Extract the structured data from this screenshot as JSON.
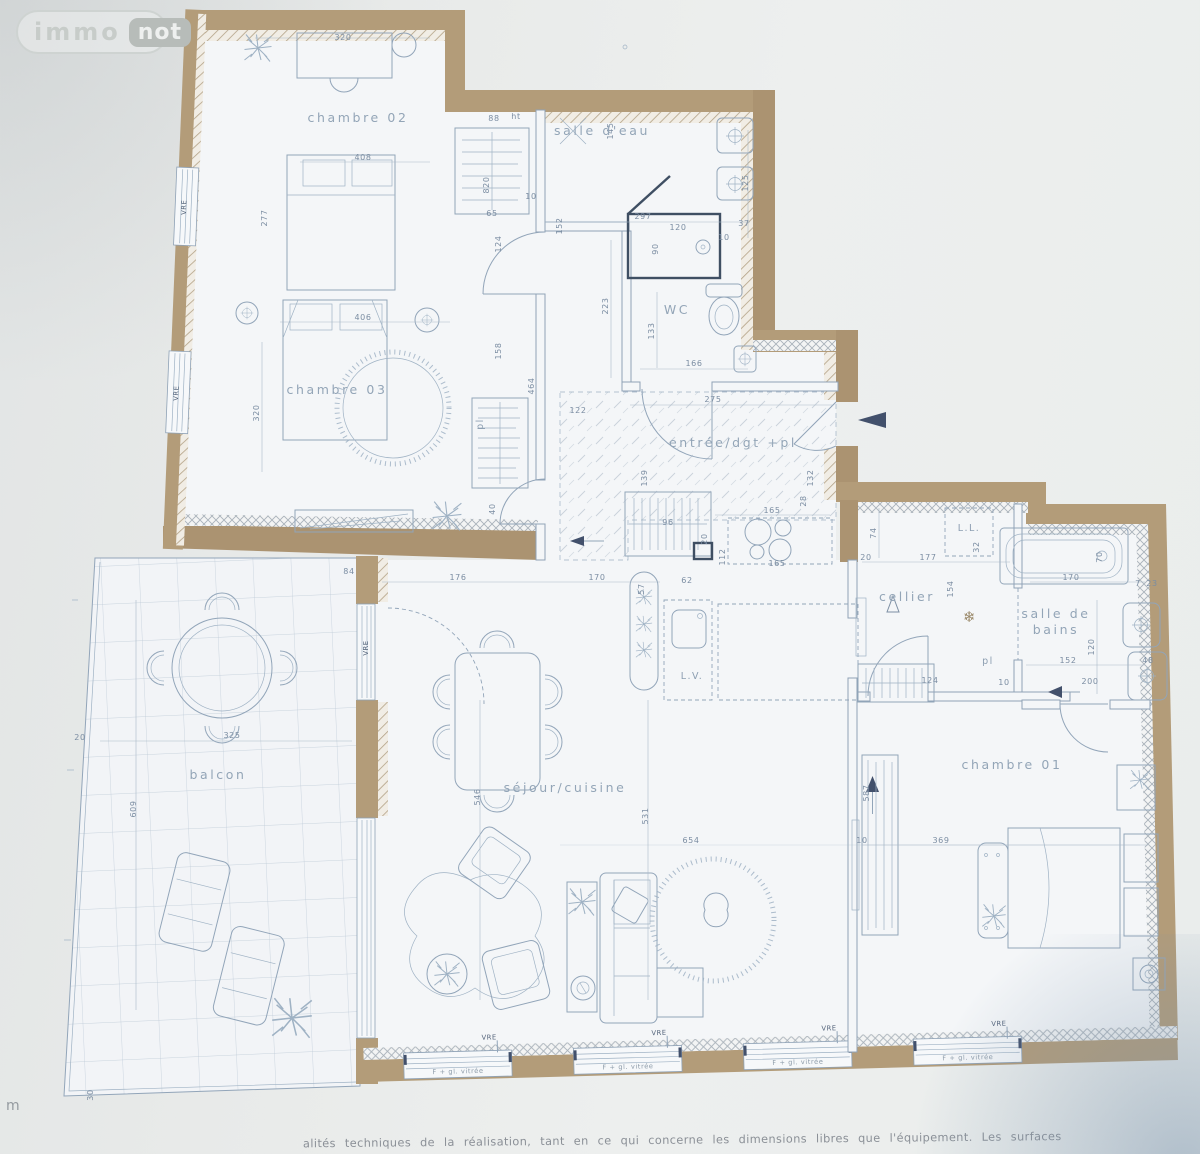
{
  "logo": {
    "immo": "immo",
    "not": "not"
  },
  "caption": "alités techniques de la réalisation, tant en ce qui concerne les dimensions libres que l'équipement. Les surfaces",
  "edge_letter": "m",
  "rooms": {
    "chambre02": "chambre 02",
    "chambre03": "chambre 03",
    "salle_eau": "salle d'eau",
    "wc": "WC",
    "entree": "entrée/dgt +pl",
    "cellier": "cellier",
    "sdb1": "salle de",
    "sdb2": "bains",
    "chambre01": "chambre 01",
    "balcon": "balcon",
    "sejour": "séjour/cuisine",
    "lv": "L.V.",
    "ll": "L.L.",
    "pl": "pl"
  },
  "windows": {
    "vre": "VRE",
    "glazed": "F + gl. vitrée"
  },
  "symbols": {
    "snowflake": "❄"
  },
  "colors": {
    "wall": "#b39c79",
    "line": "#92a5b9",
    "dark": "#42506b",
    "paper": "#f4f6f8"
  },
  "dims": {
    "d0": "320",
    "d1": "125",
    "d2": "408",
    "d3": "88",
    "d4": "ht",
    "d5": "820",
    "d6": "10",
    "d7": "152",
    "d8": "65",
    "d9": "277",
    "d10": "145",
    "d11": "297",
    "d12": "120",
    "d13": "90",
    "d14": "37",
    "d15": "10",
    "d16": "223",
    "d17": "133",
    "d18": "166",
    "d19": "406",
    "d20": "158",
    "d21": "124",
    "d22": "320",
    "d23": "464",
    "d24": "122",
    "d25": "275",
    "d26": "139",
    "d27": "132",
    "d28": "28",
    "d29": "165",
    "d30": "112",
    "d31": "20",
    "d32": "62",
    "d33": "57",
    "d34": "96",
    "d35": "165",
    "d36": "20",
    "d37": "176",
    "d38": "170",
    "d39": "546",
    "d40": "531",
    "d41": "654",
    "d42": "325",
    "d43": "609",
    "d44": "20",
    "d45": "30",
    "d46": "84",
    "d47": "74",
    "d48": "177",
    "d49": "32",
    "d50": "154",
    "d51": "170",
    "d52": "70",
    "d53": "23",
    "d54": "120",
    "d55": "152",
    "d56": "200",
    "d57": "48",
    "d58": "124",
    "d59": "10",
    "d60": "369",
    "d61": "587",
    "d62": "40",
    "d63": "7",
    "d64": "10"
  }
}
